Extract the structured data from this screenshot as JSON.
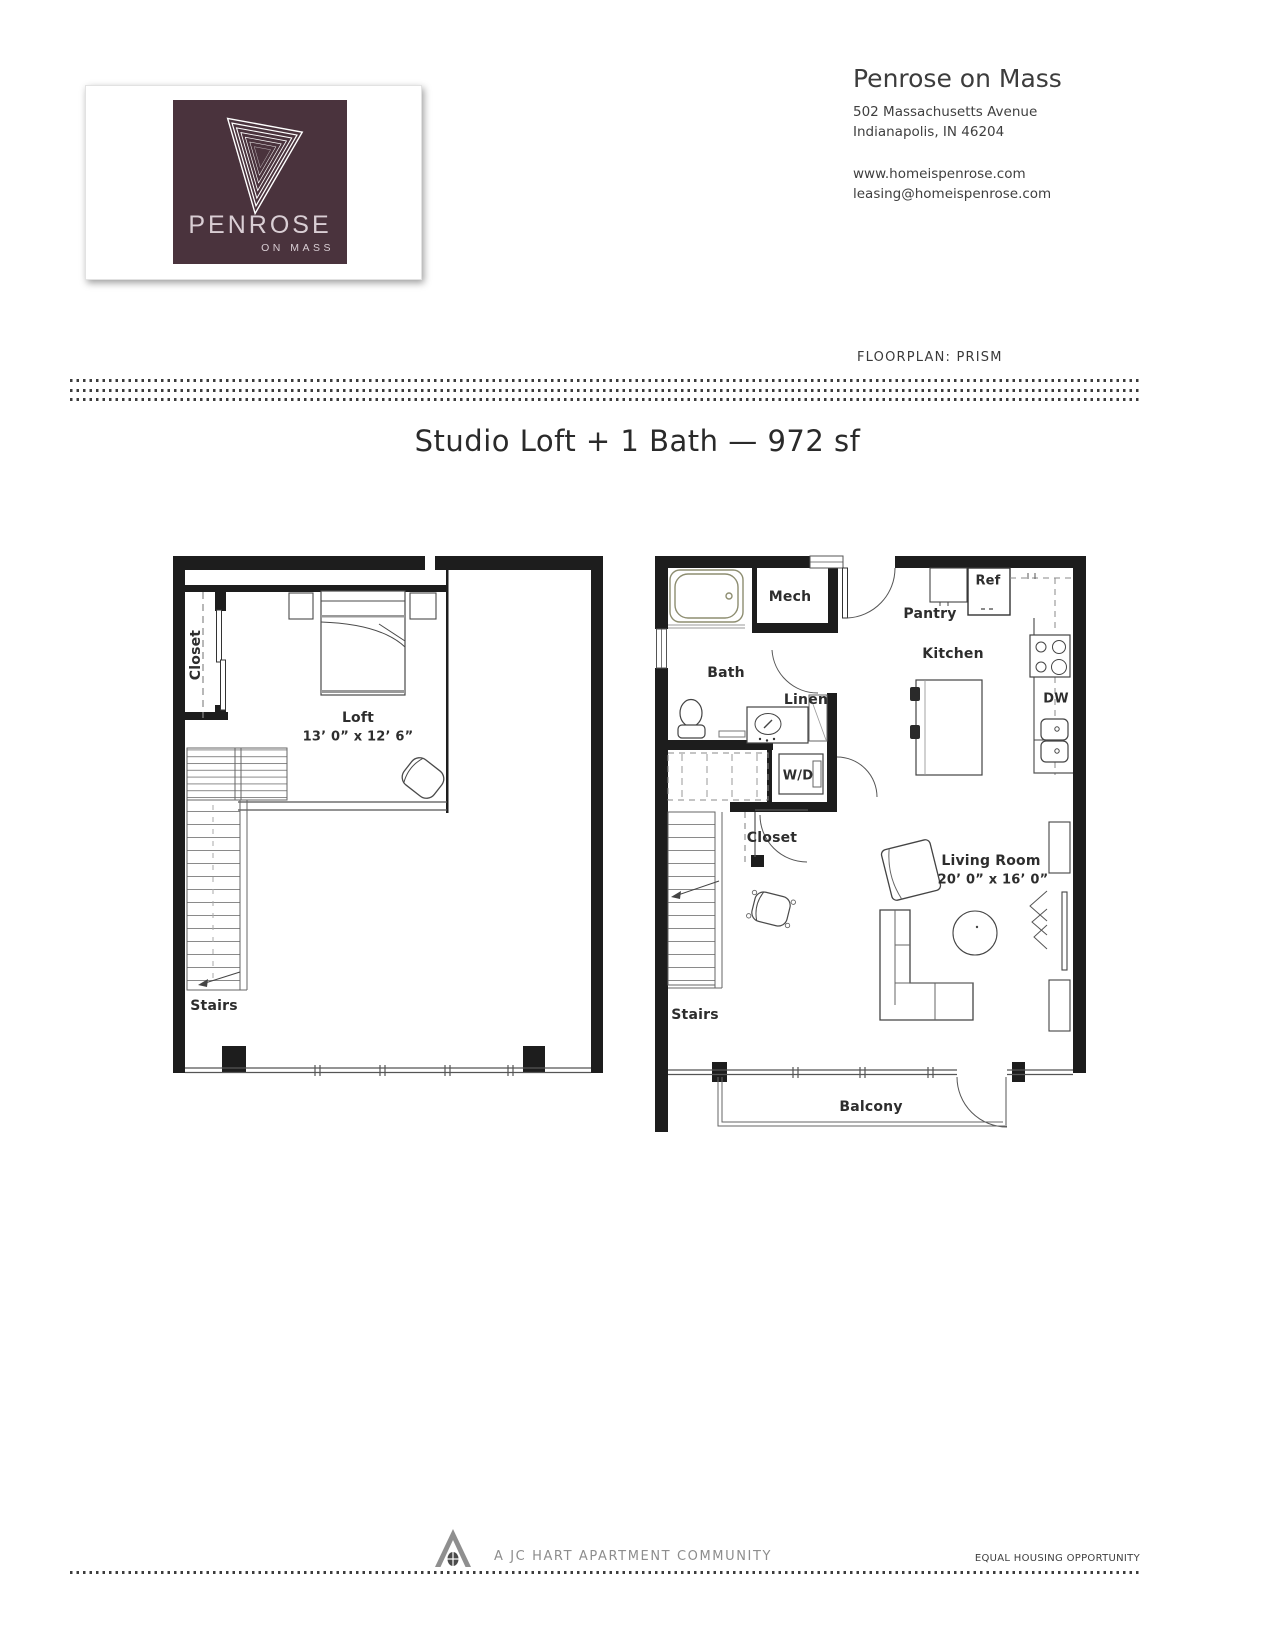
{
  "logo": {
    "brand": "PENROSE",
    "sub": "ON MASS"
  },
  "contact": {
    "name": "Penrose on Mass",
    "address_line1": "502 Massachusetts Avenue",
    "address_line2": "Indianapolis, IN 46204",
    "website": "www.homeispenrose.com",
    "email": "leasing@homeispenrose.com"
  },
  "floorplan_label": "FLOORPLAN: PRISM",
  "title": "Studio Loft + 1 Bath — 972 sf",
  "plans": {
    "loft_level": {
      "closet": "Closet",
      "room_name": "Loft",
      "room_dims": "13’ 0” x 12’ 6”",
      "stairs": "Stairs"
    },
    "main_level": {
      "mech": "Mech",
      "bath": "Bath",
      "linen": "Linen",
      "washer_dryer": "W/D",
      "closet": "Closet",
      "stairs": "Stairs",
      "pantry": "Pantry",
      "refrigerator": "Ref",
      "kitchen": "Kitchen",
      "dishwasher": "DW",
      "living_room": "Living Room",
      "living_room_dims": "20’ 0” x 16’ 0”",
      "balcony": "Balcony"
    }
  },
  "footer": {
    "community": "A JC HART APARTMENT COMMUNITY",
    "equal_housing": "EQUAL HOUSING OPPORTUNITY"
  },
  "colors": {
    "brand_plum": "#4a333d",
    "wall_black": "#1d1d1d",
    "tub_olive": "#8d8d70"
  }
}
